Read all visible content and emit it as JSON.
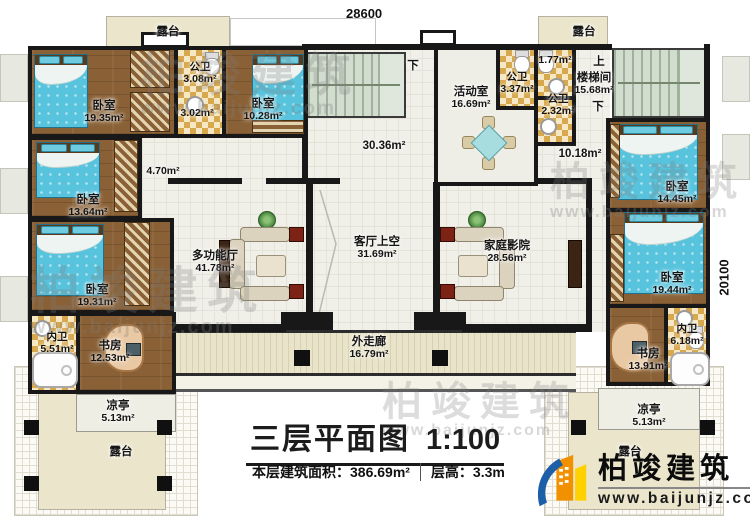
{
  "dimensions": {
    "top": "28600",
    "right": "20100"
  },
  "title": {
    "main": "三层平面图",
    "scale": "1:100",
    "area": "本层建筑面积：386.69m²",
    "floor_height": "层高：3.3m"
  },
  "brand": {
    "name": "柏竣建筑",
    "url": "www.baijunjz.com"
  },
  "stairs": {
    "up": "上",
    "down": "下"
  },
  "rooms": {
    "terrace_tl": {
      "label": "露台"
    },
    "bedroom1": {
      "label": "卧室",
      "area": "19.35m²"
    },
    "bath_public_1": {
      "label": "公卫",
      "area": "3.08m²"
    },
    "hall_302": {
      "area": "3.02m²"
    },
    "bedroom2": {
      "label": "卧室",
      "area": "10.28m²"
    },
    "bedroom3": {
      "label": "卧室",
      "area": "13.64m²"
    },
    "hall_470": {
      "area": "4.70m²"
    },
    "bedroom4": {
      "label": "卧室",
      "area": "19.31m²"
    },
    "bath_private_1": {
      "label": "内卫",
      "area": "5.51m²"
    },
    "study1": {
      "label": "书房",
      "area": "12.53m²"
    },
    "pavilion1": {
      "label": "凉亭",
      "area": "5.13m²"
    },
    "terrace_bl": {
      "label": "露台"
    },
    "multi_hall": {
      "label": "多功能厅",
      "area": "41.78m²"
    },
    "stair_hall": {
      "area": "30.36m²"
    },
    "living_void": {
      "label": "客厅上空",
      "area": "31.69m²"
    },
    "activity": {
      "label": "活动室",
      "area": "16.69m²"
    },
    "bath_public_2": {
      "label": "公卫",
      "area": "3.37m²"
    },
    "hall_177": {
      "area": "1.77m²"
    },
    "bath_public_3": {
      "label": "公卫",
      "area": "2.32m²"
    },
    "stairwell": {
      "label": "楼梯间",
      "area": "15.68m²"
    },
    "hall_1018": {
      "area": "10.18m²"
    },
    "theater": {
      "label": "家庭影院",
      "area": "28.56m²"
    },
    "corridor": {
      "label": "外走廊",
      "area": "16.79m²"
    },
    "terrace_tr": {
      "label": "露台"
    },
    "bedroom5": {
      "label": "卧室",
      "area": "14.45m²"
    },
    "bedroom6": {
      "label": "卧室",
      "area": "19.44m²"
    },
    "bath_private_2": {
      "label": "内卫",
      "area": "6.18m²"
    },
    "study2": {
      "label": "书房",
      "area": "13.91m²"
    },
    "pavilion2": {
      "label": "凉亭",
      "area": "5.13m²"
    },
    "terrace_br": {
      "label": "露台"
    }
  }
}
